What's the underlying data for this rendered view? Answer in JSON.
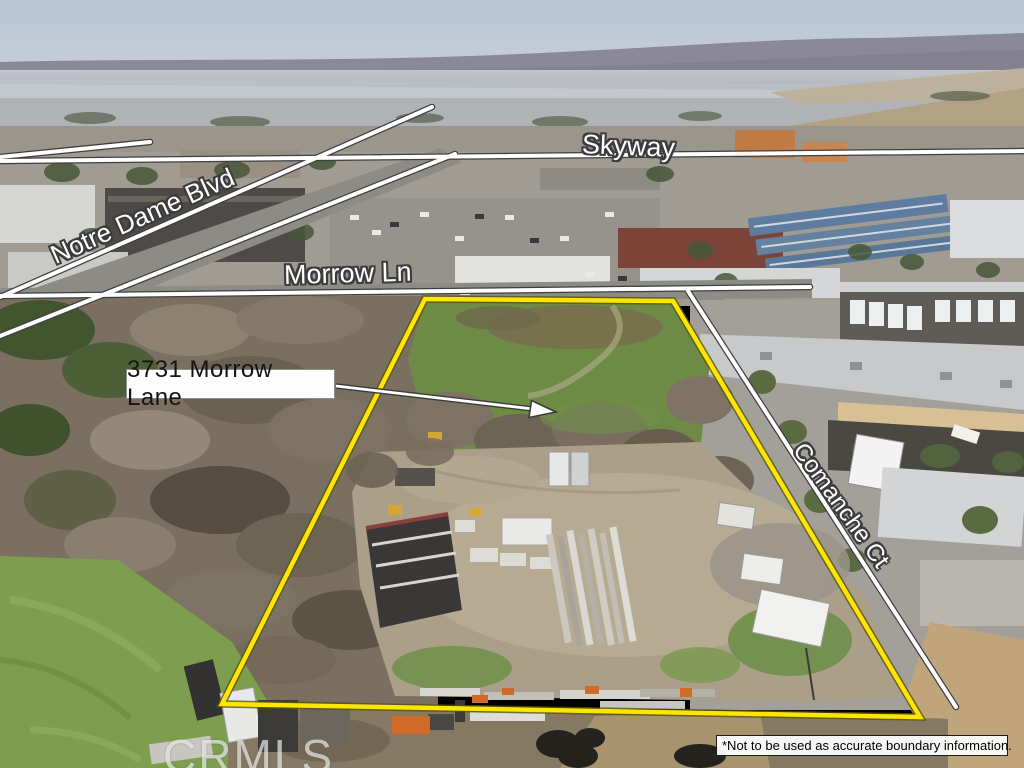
{
  "image_type": "annotated aerial real-estate photograph",
  "labels": {
    "skyway": "Skyway",
    "notre_dame": "Notre Dame Blvd",
    "morrow": "Morrow Ln",
    "comanche": "Comanche Ct"
  },
  "address_callout": {
    "text": "3731 Morrow Lane"
  },
  "watermark": {
    "text": "CRMLS"
  },
  "disclaimer": {
    "text": "*Not to be used as accurate boundary information."
  },
  "colors": {
    "boundary_yellow": "#FFE500",
    "boundary_casing": "#55550E",
    "street_line": "#FFFFFF",
    "street_line_casing": "#3F3F3F",
    "label_text": "#FFFFFF",
    "label_outline": "#3C3C3C",
    "address_text": "#141414",
    "address_bg": "#FEFEFE",
    "disclaimer_text": "#000000",
    "disclaimer_bg": "#FFFFFF"
  }
}
